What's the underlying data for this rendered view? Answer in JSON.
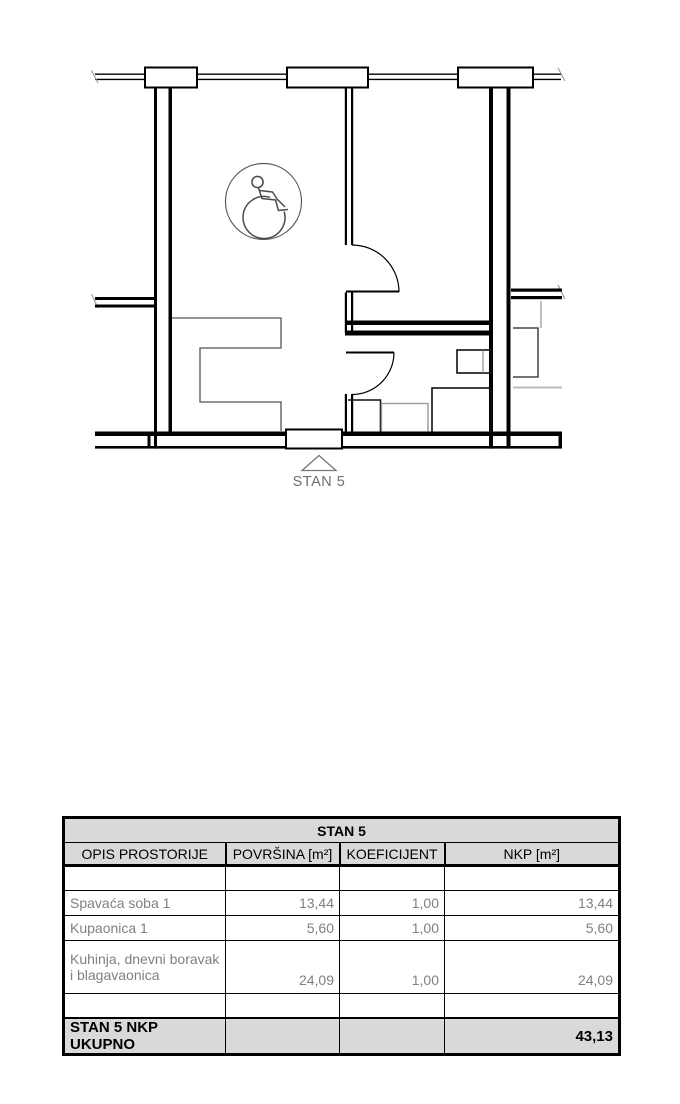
{
  "plan": {
    "apartment_label": "STAN 5",
    "colors": {
      "wall_line": "#000000",
      "fixture_gray": "#999999",
      "counter_gray": "#555555",
      "label_text": "#707070"
    }
  },
  "table": {
    "title": "STAN 5",
    "headers": {
      "opis": "OPIS PROSTORIJE",
      "povrsina": "POVRŠINA [m²]",
      "koeficijent": "KOEFICIJENT",
      "nkp": "NKP [m²]"
    },
    "rows": [
      {
        "name": "Spavaća soba 1",
        "povrsina": "13,44",
        "koeficijent": "1,00",
        "nkp": "13,44"
      },
      {
        "name": "Kupaonica 1",
        "povrsina": "5,60",
        "koeficijent": "1,00",
        "nkp": "5,60"
      },
      {
        "name": "Kuhinja, dnevni boravak i blagavaonica",
        "povrsina": "24,09",
        "koeficijent": "1,00",
        "nkp": "24,09"
      }
    ],
    "total": {
      "label": "STAN 5 NKP UKUPNO",
      "nkp": "43,13"
    },
    "colors": {
      "header_fill": "#d9d9d9",
      "row_text": "#808080",
      "border": "#000000"
    }
  }
}
